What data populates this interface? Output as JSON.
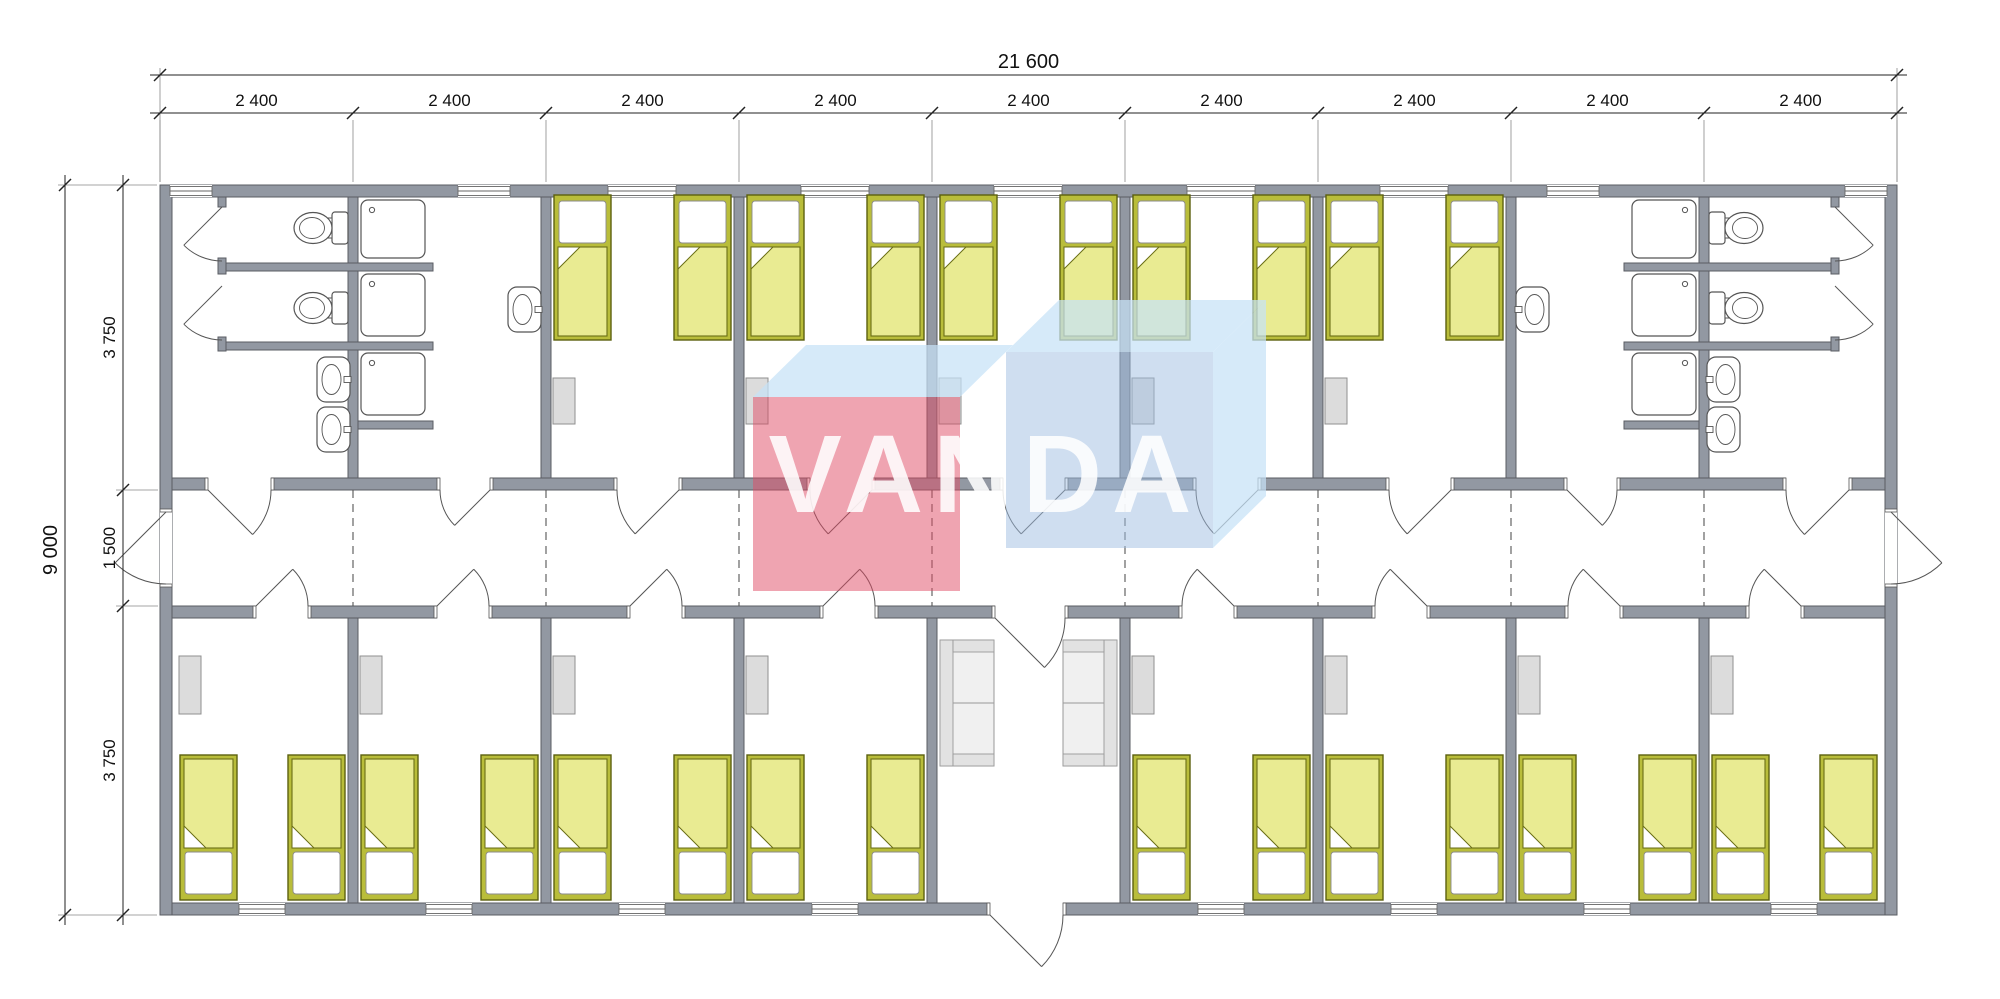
{
  "title": "VANDA modular building floor plan",
  "watermark": {
    "text": "VANDA",
    "text_color": "rgba(255,255,255,0.87)",
    "cube_red": "rgba(224,74,99,0.50)",
    "cube_blue": "rgba(160,190,225,0.50)",
    "cube_top": "rgba(198,226,246,0.72)",
    "font_size": 110,
    "center_x": 985,
    "baseline_y": 512,
    "left_cube_front": [
      753,
      397,
      207,
      194
    ],
    "left_cube_top": [
      [
        753,
        397
      ],
      [
        806,
        345
      ],
      [
        1013,
        345
      ],
      [
        960,
        397
      ]
    ],
    "right_cube_front": [
      1006,
      352,
      207,
      196
    ],
    "right_cube_top": [
      [
        1006,
        352
      ],
      [
        1059,
        300
      ],
      [
        1266,
        300
      ],
      [
        1213,
        352
      ]
    ],
    "right_cube_side": [
      [
        1213,
        352
      ],
      [
        1266,
        300
      ],
      [
        1266,
        496
      ],
      [
        1213,
        548
      ]
    ]
  },
  "dimensions": {
    "total_width_label": "21 600",
    "module_labels": [
      "2 400",
      "2 400",
      "2 400",
      "2 400",
      "2 400",
      "2 400",
      "2 400",
      "2 400",
      "2 400"
    ],
    "total_height_label": "9 000",
    "vertical_labels": [
      "3 750",
      "1 500",
      "3 750"
    ],
    "top_total": {
      "y": 75,
      "x1": 160,
      "x2": 1897
    },
    "top_modules": {
      "y": 113,
      "bounds": [
        160,
        353,
        546,
        739,
        932,
        1125,
        1318,
        1511,
        1704,
        1897
      ]
    },
    "left_total": {
      "x": 65,
      "y1": 185,
      "y2": 915
    },
    "left_segs": {
      "x": 123,
      "ticks": [
        185,
        490,
        606,
        915
      ]
    },
    "line_color": "#222222",
    "text_color": "#111111"
  },
  "plan": {
    "colors": {
      "wall_fill": "#9298a2",
      "wall_stroke": "#5a5c63",
      "fixture_stroke": "#555555",
      "fixture_fill": "#ffffff",
      "bed_frame": "#b9bd3a",
      "bed_frame_stroke": "#5c600f",
      "blanket": "#e9eb92",
      "blanket_stroke": "#6a6e15",
      "pillow": "#ffffff",
      "pillow_stroke": "#8a8a8a",
      "wardrobe": "#dcdcdc",
      "wardrobe_stroke": "#8f8f8f",
      "sofa": "#f0f0f0",
      "sofa_band": "#e2e2e2",
      "sofa_stroke": "#999999",
      "door_line": "#555555",
      "dash_line": "#555555"
    },
    "building": {
      "x1": 160,
      "y1": 185,
      "x2": 1897,
      "y2": 915,
      "ext": 12
    },
    "corridor": {
      "top_wall_y": 478,
      "bottom_wall_y": 606,
      "wall_h": 12
    },
    "partitions": {
      "bounds": [
        353,
        546,
        739,
        932,
        1125,
        1318,
        1511,
        1704
      ],
      "w": 10,
      "top_y": 197,
      "top_h": 281,
      "bot_y": 618,
      "bot_h": 285
    },
    "stub_walls": [
      [
        222,
        263,
        211,
        8
      ],
      [
        222,
        342,
        211,
        8
      ],
      [
        358,
        421,
        75,
        8
      ],
      [
        1624,
        263,
        211,
        8
      ],
      [
        1624,
        342,
        211,
        8
      ],
      [
        1624,
        421,
        75,
        8
      ],
      [
        218,
        197,
        8,
        10
      ],
      [
        218,
        258,
        8,
        16
      ],
      [
        218,
        337,
        8,
        14
      ],
      [
        1831,
        197,
        8,
        10
      ],
      [
        1831,
        258,
        8,
        16
      ],
      [
        1831,
        337,
        8,
        14
      ]
    ],
    "windows_top": [
      [
        170,
        42
      ],
      [
        458,
        52
      ],
      [
        608,
        68
      ],
      [
        801,
        68
      ],
      [
        994,
        68
      ],
      [
        1187,
        68
      ],
      [
        1380,
        68
      ],
      [
        1547,
        52
      ],
      [
        1845,
        42
      ]
    ],
    "windows_bottom": [
      [
        239,
        46
      ],
      [
        426,
        46
      ],
      [
        619,
        46
      ],
      [
        812,
        46
      ],
      [
        1198,
        46
      ],
      [
        1391,
        46
      ],
      [
        1584,
        46
      ],
      [
        1771,
        46
      ]
    ],
    "doors_corridor_top": [
      {
        "x1": 208,
        "x2": 271,
        "h": "L"
      },
      {
        "x1": 440,
        "x2": 490,
        "h": "R"
      },
      {
        "x1": 617,
        "x2": 679,
        "h": "R"
      },
      {
        "x1": 810,
        "x2": 872,
        "h": "R"
      },
      {
        "x1": 1003,
        "x2": 1065,
        "h": "R"
      },
      {
        "x1": 1196,
        "x2": 1258,
        "h": "R"
      },
      {
        "x1": 1389,
        "x2": 1451,
        "h": "R"
      },
      {
        "x1": 1567,
        "x2": 1617,
        "h": "L"
      },
      {
        "x1": 1786,
        "x2": 1849,
        "h": "R"
      }
    ],
    "doors_corridor_bottom": [
      {
        "x1": 256,
        "x2": 308,
        "h": "L"
      },
      {
        "x1": 437,
        "x2": 489,
        "h": "L"
      },
      {
        "x1": 630,
        "x2": 682,
        "h": "L"
      },
      {
        "x1": 823,
        "x2": 875,
        "h": "L"
      },
      {
        "x1": 1182,
        "x2": 1234,
        "h": "R"
      },
      {
        "x1": 1375,
        "x2": 1427,
        "h": "R"
      },
      {
        "x1": 1568,
        "x2": 1620,
        "h": "R"
      },
      {
        "x1": 1749,
        "x2": 1801,
        "h": "R"
      }
    ],
    "door_vestibule_inner": {
      "x1": 995,
      "x2": 1065,
      "h": "L"
    },
    "door_vestibule_outer": {
      "x1": 990,
      "x2": 1063,
      "h": "L"
    },
    "doors_end": [
      {
        "side": "W",
        "y1": 512,
        "y2": 584
      },
      {
        "side": "E",
        "y1": 512,
        "y2": 584
      }
    ],
    "stall_doors": [
      {
        "hx": 222,
        "hy": 207,
        "dir": -1
      },
      {
        "hx": 222,
        "hy": 286,
        "dir": -1
      },
      {
        "hx": 1835,
        "hy": 207,
        "dir": 1
      },
      {
        "hx": 1835,
        "hy": 286,
        "dir": 1
      }
    ],
    "dash_lines": {
      "xs": [
        353,
        546,
        739,
        932,
        1125,
        1318,
        1511,
        1704
      ],
      "y1": 490,
      "y2": 606
    },
    "beds_top": {
      "y": 195,
      "xs": [
        554,
        674,
        747,
        867,
        940,
        1060,
        1133,
        1253,
        1326,
        1446
      ]
    },
    "beds_bottom": {
      "y": 755,
      "xs": [
        180,
        288,
        361,
        481,
        554,
        674,
        747,
        867,
        1133,
        1253,
        1326,
        1446,
        1519,
        1639,
        1712,
        1820
      ]
    },
    "bed_size": {
      "w": 57,
      "h": 145
    },
    "wardrobes_top": {
      "y": 378,
      "h": 46,
      "xs": [
        553,
        746,
        939,
        1132,
        1325
      ]
    },
    "wardrobes_bottom": {
      "y": 656,
      "h": 58,
      "xs": [
        179,
        360,
        553,
        746,
        1132,
        1325,
        1518,
        1711
      ]
    },
    "wardrobe_w": 22,
    "toilets": [
      {
        "cy": 228,
        "side": "L"
      },
      {
        "cy": 308,
        "side": "L"
      },
      {
        "cy": 228,
        "side": "R"
      },
      {
        "cy": 308,
        "side": "R"
      }
    ],
    "basins": [
      {
        "x": 317,
        "y": 357,
        "tap": "R"
      },
      {
        "x": 317,
        "y": 407,
        "tap": "R"
      },
      {
        "x": 1707,
        "y": 357,
        "tap": "L"
      },
      {
        "x": 1707,
        "y": 407,
        "tap": "L"
      },
      {
        "x": 508,
        "y": 287,
        "tap": "R"
      },
      {
        "x": 1516,
        "y": 287,
        "tap": "L"
      }
    ],
    "basin_size": {
      "w": 33,
      "h": 45
    },
    "showers": {
      "ys": [
        200,
        274,
        353
      ],
      "hs": [
        58,
        62,
        62
      ],
      "left_x": 361,
      "right_x": 1632,
      "w": 64
    },
    "sofas": [
      {
        "x": 940,
        "y": 640,
        "back": "L"
      },
      {
        "x": 1063,
        "y": 640,
        "back": "R"
      }
    ],
    "sofa_size": {
      "w": 54,
      "h": 126
    }
  }
}
